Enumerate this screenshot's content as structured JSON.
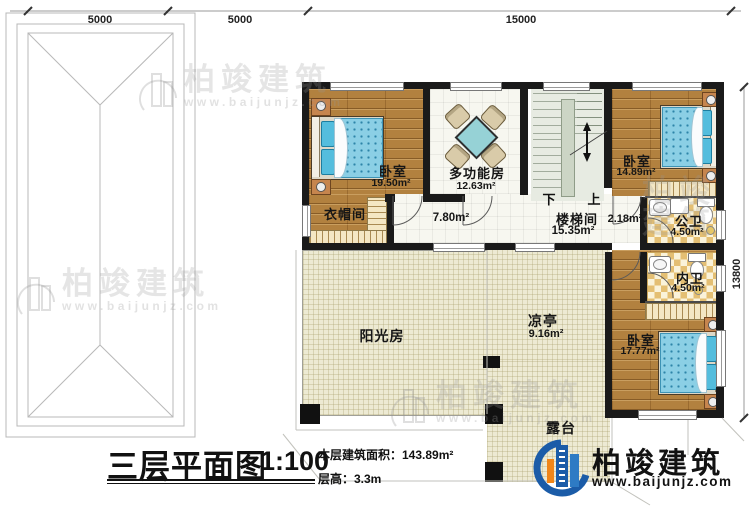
{
  "dimensions": {
    "top": [
      "5000",
      "5000",
      "15000"
    ],
    "right": "13800"
  },
  "rooms": {
    "bedroom1": {
      "name": "卧室",
      "area": "19.50m²"
    },
    "cloakroom": {
      "name": "衣帽间"
    },
    "multifunction": {
      "name": "多功能房",
      "area": "12.63m²"
    },
    "hallway": {
      "area": "7.80m²"
    },
    "stairwell": {
      "name": "楼梯间",
      "area": "15.35m²",
      "down": "下",
      "up": "上"
    },
    "corridor": {
      "area": "2.18m²"
    },
    "bedroom2": {
      "name": "卧室",
      "area": "14.89m²"
    },
    "public_bath": {
      "name": "公卫",
      "area": "4.50m²"
    },
    "inner_bath": {
      "name": "内卫",
      "area": "4.50m²"
    },
    "bedroom3": {
      "name": "卧室",
      "area": "17.77m²"
    },
    "sunroom": {
      "name": "阳光房"
    },
    "pavilion": {
      "name": "凉亭",
      "area": "9.16m²"
    },
    "terrace": {
      "name": "露台"
    }
  },
  "title": {
    "main": "三层平面图",
    "scale": "1:100",
    "area_line": "本层建筑面积：143.89m²",
    "height_line": "层高：3.3m"
  },
  "logo": {
    "name": "柏竣建筑",
    "url": "www.baijunjz.com"
  },
  "watermark": {
    "name": "柏竣建筑",
    "url": "www.baijunjz.com"
  },
  "colors": {
    "wall": "#1a1a1a",
    "wood_floor": "#b2813f",
    "bed_blue": "#8bcfe5",
    "tile_cream": "#edead3",
    "bath_checker": "#e4bf73",
    "logo_blue": "#1b5ca8",
    "logo_orange": "#f08619"
  }
}
